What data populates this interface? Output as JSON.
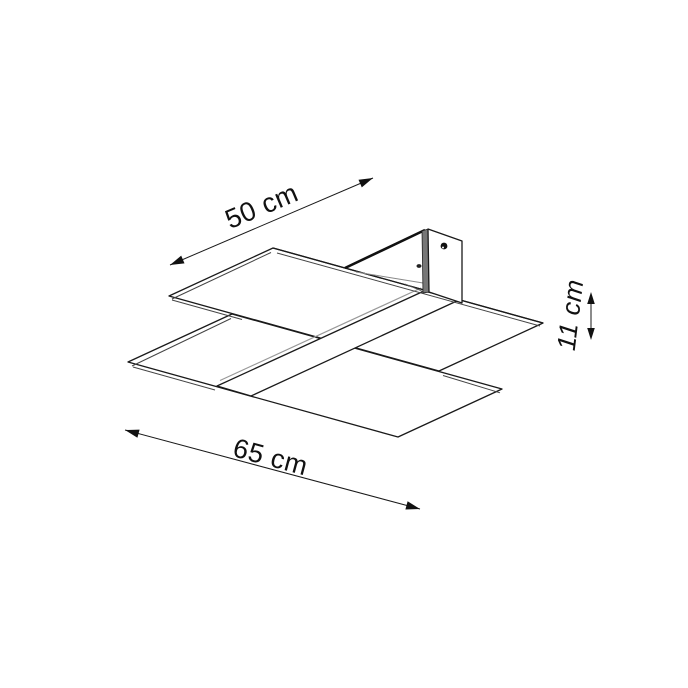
{
  "page": {
    "background": "#ffffff"
  },
  "diagram": {
    "stroke_color": "#1a1a1a",
    "shade_color": "#7a7a7a",
    "dims": {
      "depth": {
        "label": "50 cm"
      },
      "width": {
        "label": "65 cm"
      },
      "height": {
        "label": "11 cm"
      }
    }
  }
}
